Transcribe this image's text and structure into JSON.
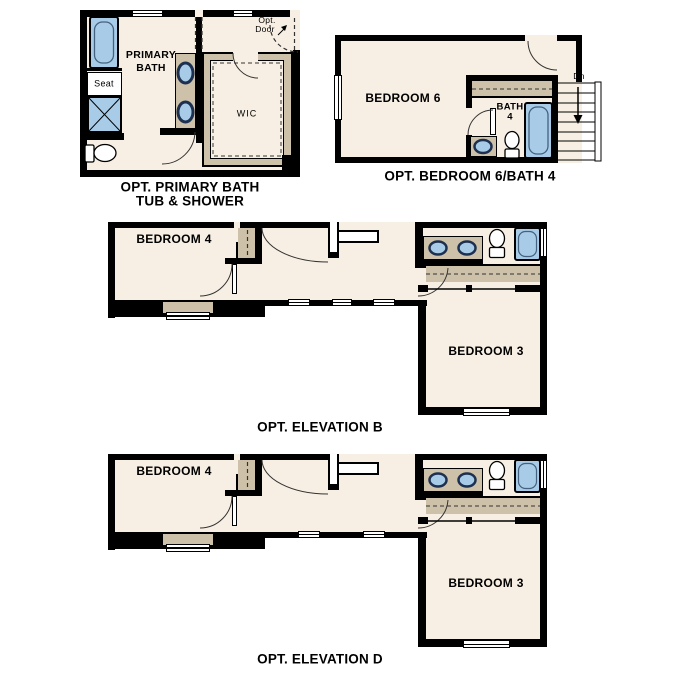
{
  "colors": {
    "wall": "#000000",
    "floor": "#f7efe3",
    "counter": "#cdc1a9",
    "fixture_blue": "#a8cce8",
    "sink_rim": "#1d3050"
  },
  "plans": {
    "primary_bath": {
      "caption_line1": "OPT. PRIMARY BATH",
      "caption_line2": "TUB & SHOWER",
      "labels": {
        "room_line1": "PRIMARY",
        "room_line2": "BATH",
        "seat": "Seat",
        "wic": "WIC",
        "opt_door_line1": "Opt.",
        "opt_door_line2": "Door"
      }
    },
    "bedroom6": {
      "caption": "OPT. BEDROOM 6/BATH 4",
      "labels": {
        "bedroom": "BEDROOM 6",
        "bath_line1": "BATH",
        "bath_line2": "4",
        "down": "Dn"
      }
    },
    "elevation_b": {
      "caption": "OPT. ELEVATION B",
      "labels": {
        "bedroom4": "BEDROOM 4",
        "bedroom3": "BEDROOM 3"
      }
    },
    "elevation_d": {
      "caption": "OPT. ELEVATION D",
      "labels": {
        "bedroom4": "BEDROOM 4",
        "bedroom3": "BEDROOM 3"
      }
    }
  }
}
